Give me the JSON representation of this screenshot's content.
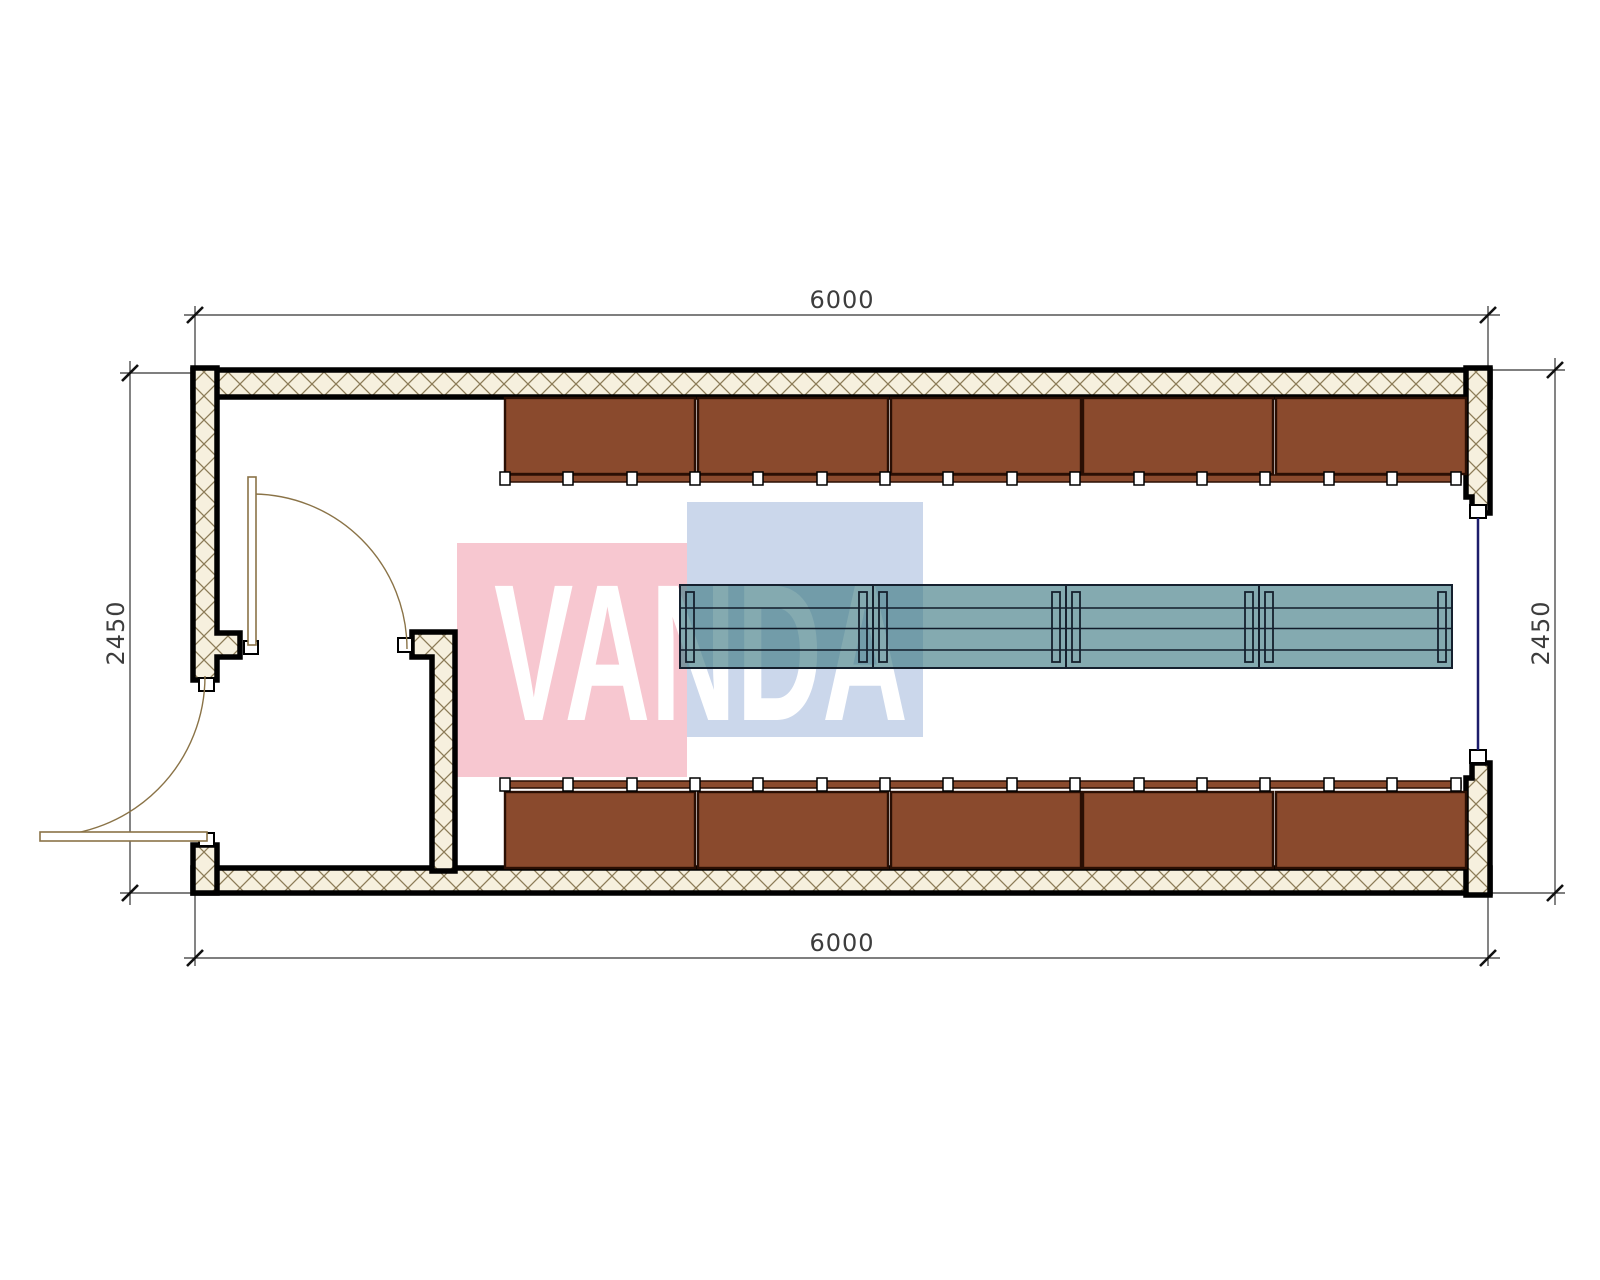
{
  "drawing": {
    "type": "container-floor-plan",
    "dimensions": {
      "top": "6000",
      "bottom": "6000",
      "left": "2450",
      "right": "2450"
    },
    "watermark": {
      "text": "VANDA"
    },
    "furniture": {
      "locker_units_top": 5,
      "locker_units_bottom": 5,
      "table_segments": 4,
      "doors": 2,
      "windows": 1
    },
    "colors": {
      "hatch-bg": "#f6f0de",
      "hatch-line": "#8c7c58",
      "wall-stroke": "#000000",
      "locker": "#8a4a2d",
      "locker-border": "#2a0f04",
      "table-fill": "rgba(66,125,134,0.65)",
      "table-border": "#15202e",
      "table-line": "#111c2b",
      "door": "#8a7347",
      "window": "#1d1d6b",
      "dim": "#333333",
      "dim-text": "#3d3d3d",
      "wm-pink": "#f7c7d0",
      "wm-blue": "#cbd7eb"
    }
  }
}
